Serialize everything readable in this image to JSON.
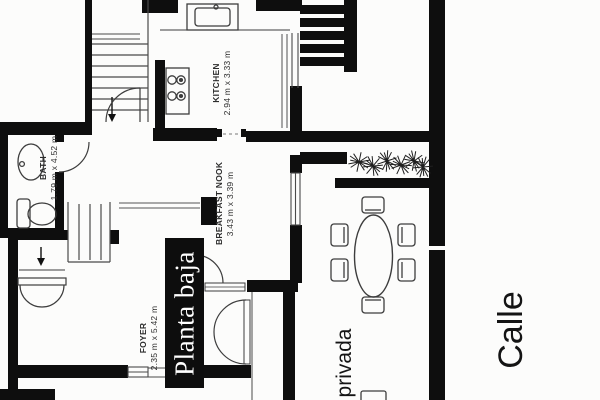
{
  "floor_plan": {
    "title": "Planta baja",
    "rooms": [
      {
        "name": "KITCHEN",
        "dimensions": "2.94 m x 3.33 m"
      },
      {
        "name": "BREAKFAST NOOK",
        "dimensions": "3.43 m x 3.39 m"
      },
      {
        "name": "BATH",
        "dimensions": "1.79 m x 4.52 m"
      },
      {
        "name": "FOYER",
        "dimensions": "2.35 m x 5.42 m"
      }
    ],
    "streets": {
      "side": "privada",
      "main": "Calle"
    },
    "colors": {
      "wall": "#0e0e0e",
      "background": "#fcfcfb",
      "title_background": "#0d0d0d",
      "title_text": "#ffffff",
      "thin_line": "#3d3d3d"
    }
  }
}
